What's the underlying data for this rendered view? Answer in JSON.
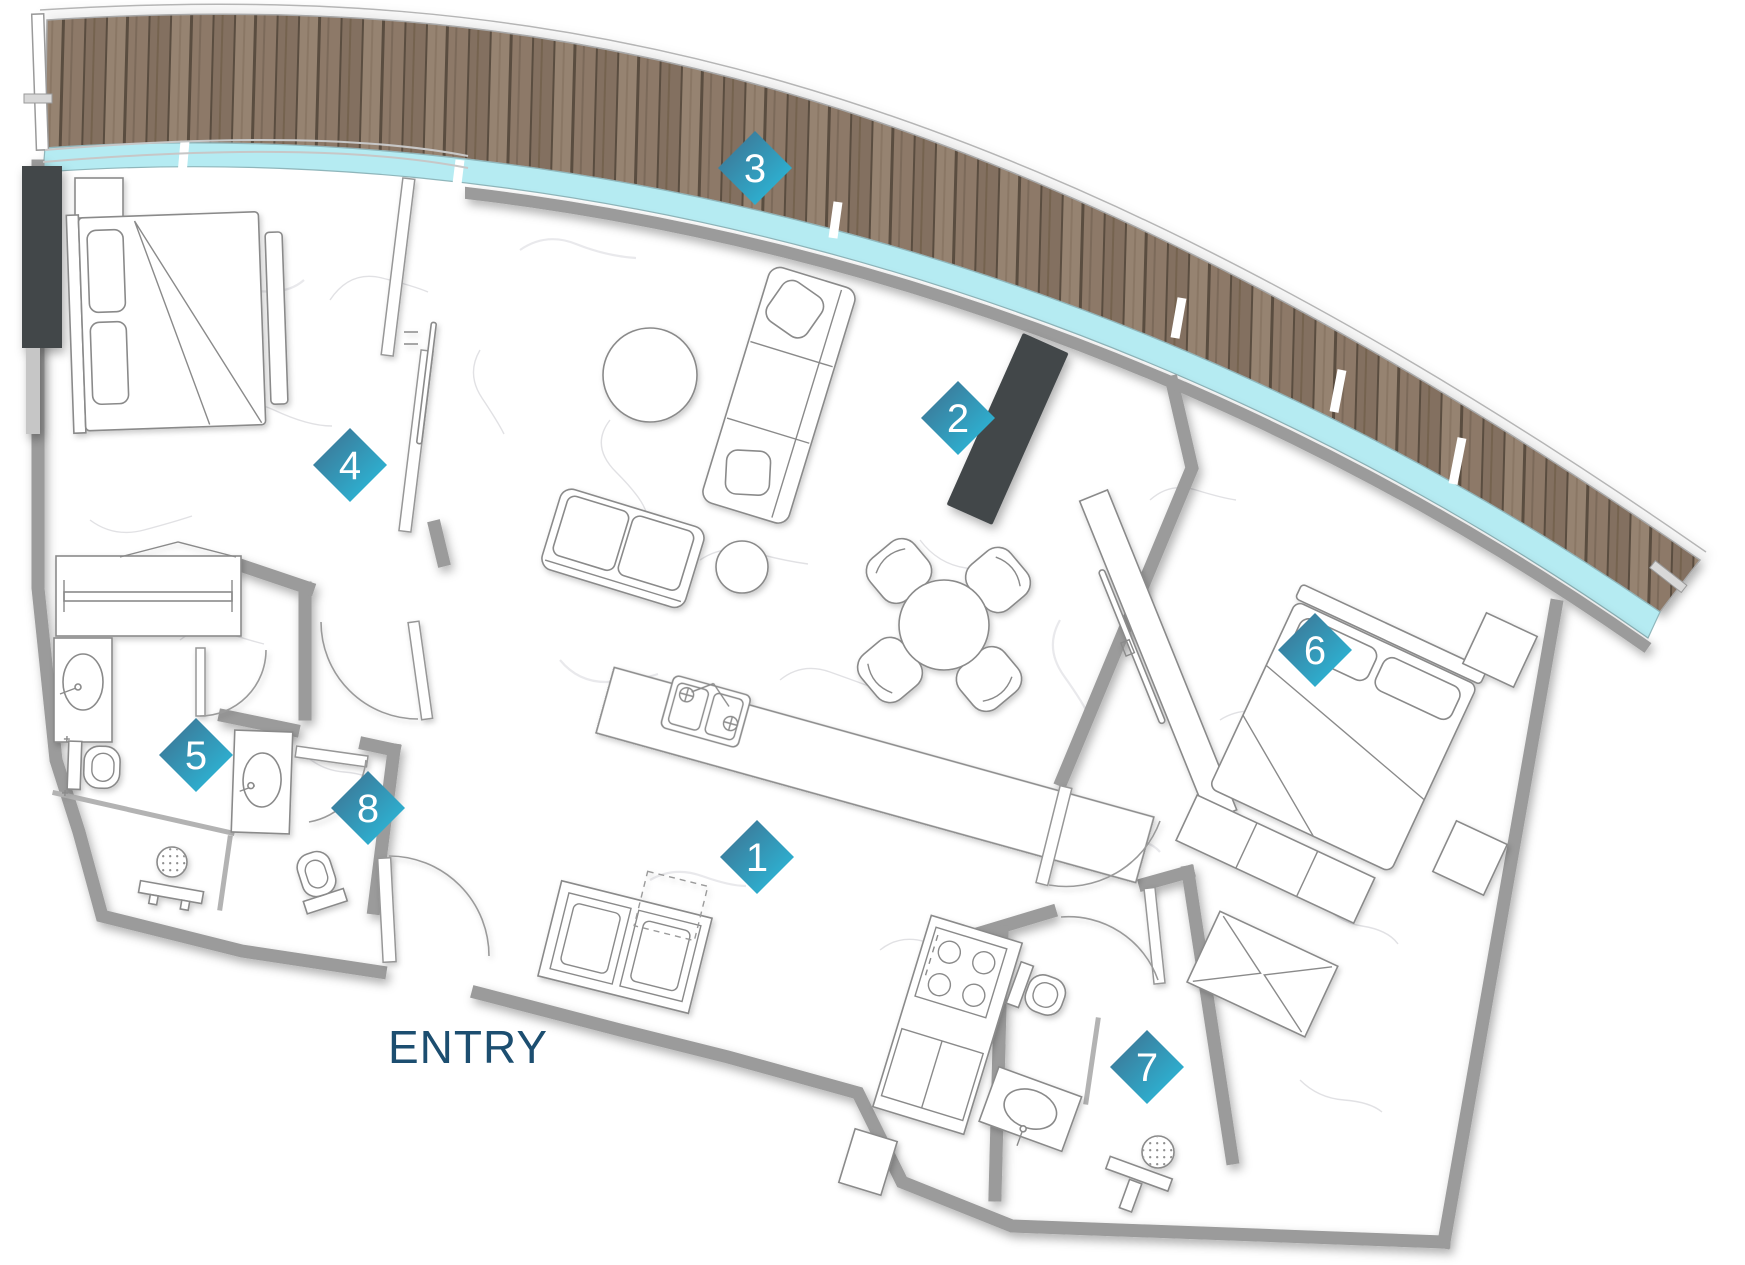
{
  "entry": {
    "label": "ENTRY",
    "color": "#1c4e70"
  },
  "markers": [
    {
      "label": "1"
    },
    {
      "label": "2"
    },
    {
      "label": "3"
    },
    {
      "label": "4"
    },
    {
      "label": "5"
    },
    {
      "label": "6"
    },
    {
      "label": "7"
    },
    {
      "label": "8"
    }
  ],
  "colors": {
    "marker_gradient_start": "#3f6d8c",
    "marker_gradient_end": "#29c1e2",
    "marker_text": "#ffffff",
    "wood_plank_a": "#8d7968",
    "wood_plank_b": "#837060",
    "wood_plank_c": "#968371",
    "wood_gap": "#5a4d40",
    "glass": "#b5ebf2",
    "wall": "#9b9b9b",
    "dark_fixture": "#43474a",
    "furniture_line": "#8a8a8a",
    "floor": "#ffffff"
  }
}
